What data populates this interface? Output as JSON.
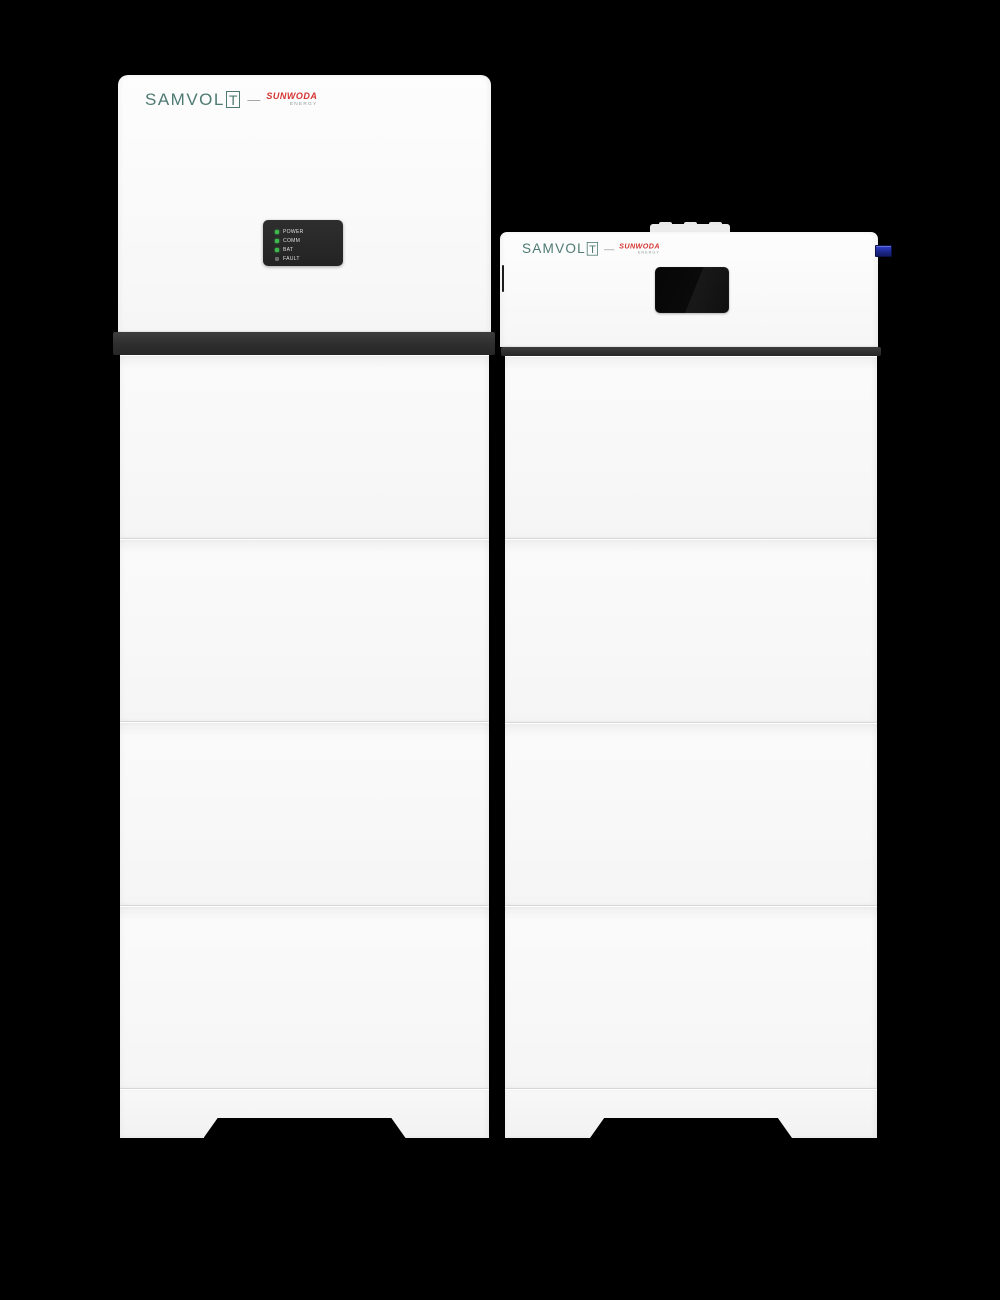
{
  "scene": {
    "background_color": "#000000",
    "description": "Two white stacked residential energy-storage towers (inverter tower and battery tower) on a black background"
  },
  "branding": {
    "primary": "SAMVOL",
    "primary_boxed": "T",
    "dash": "—",
    "secondary": "SUNWODA",
    "secondary_sub": "ENERGY",
    "colors": {
      "primary": "#4e7a72",
      "secondary": "#d43431",
      "secondary_sub": "#8f9a9a"
    }
  },
  "left_unit": {
    "kind": "inverter battery tower",
    "body_color": "#f8f8f8",
    "band_color": "#2e2e2e",
    "battery_module_count": 4,
    "led_panel": {
      "panel_color": "#282828",
      "led_on_color": "#3db94d",
      "led_off_color": "#6a6a6a",
      "indicators": [
        {
          "label": "POWER",
          "state": "on"
        },
        {
          "label": "COMM",
          "state": "on"
        },
        {
          "label": "BAT",
          "state": "on"
        },
        {
          "label": "FAULT",
          "state": "off"
        }
      ]
    }
  },
  "right_unit": {
    "kind": "battery tower with display",
    "body_color": "#f8f8f8",
    "band_color": "#2e2e2e",
    "battery_module_count": 4,
    "display": {
      "state": "off",
      "color": "#0a0a0a"
    },
    "breaker_switch_color": "#1c2688"
  }
}
